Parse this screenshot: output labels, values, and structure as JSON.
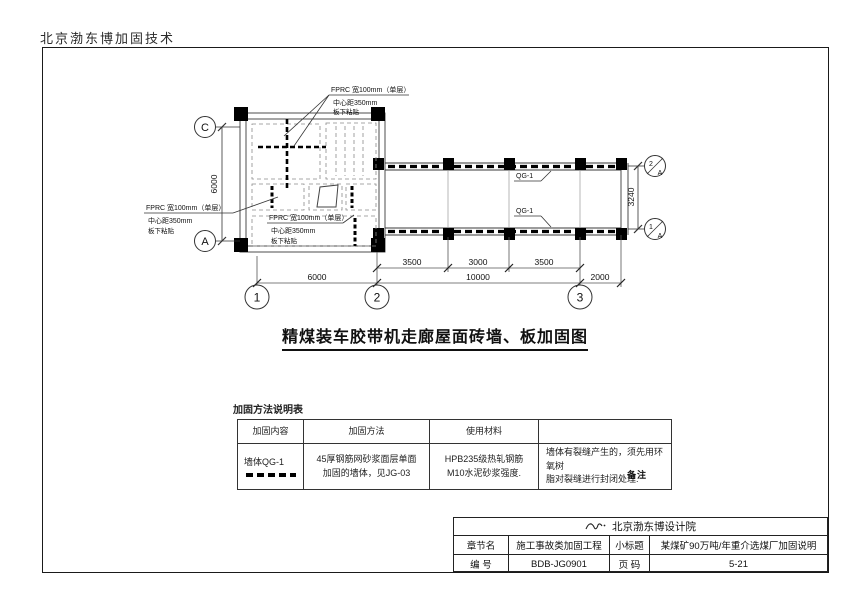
{
  "page": {
    "header": "北京渤东博加固技术"
  },
  "plan": {
    "ann": {
      "l1": "FPRC 宽100mm（单层）",
      "l2": "中心距350mm",
      "l3": "板下粘贴"
    },
    "qg1": "QG-1",
    "axis": {
      "c": "C",
      "a": "A",
      "one": "1",
      "two": "2",
      "three": "3",
      "f2": "2",
      "f1": "1",
      "fa": "A"
    },
    "dims": {
      "v6000": "6000",
      "v3240": "3240",
      "a3500": "3500",
      "b3000": "3000",
      "c3500": "3500",
      "d6000": "6000",
      "e10000": "10000",
      "f2000": "2000"
    },
    "title": "精煤装车胶带机走廊屋面砖墙、板加固图"
  },
  "table": {
    "caption": "加固方法说明表",
    "col1": "加固内容",
    "col2": "加固方法",
    "col3": "使用材料",
    "col4": "",
    "r1c1": "墙体QG-1",
    "r1c2a": "45厚钢筋网砂浆面层单面",
    "r1c2b": "加固的墙体，见JG-03",
    "r1c3a": "HPB235级热轧钢筋",
    "r1c3b": "M10水泥砂浆强度.",
    "r1c4a": "墙体有裂缝产生的，须先用环氧树",
    "r1c4b": "脂对裂缝进行封闭处理.",
    "r1c4overlay": "备注"
  },
  "titleblock": {
    "company": "北京渤东博设计院",
    "r1k1": "章节名",
    "r1v1": "施工事故类加固工程",
    "r1k2": "小标题",
    "r1v2": "某煤矿90万吨/年重介选煤厂加固说明",
    "r2k1": "编  号",
    "r2v1": "BDB-JG0901",
    "r2k2": "页  码",
    "r2v2": "5-21"
  }
}
